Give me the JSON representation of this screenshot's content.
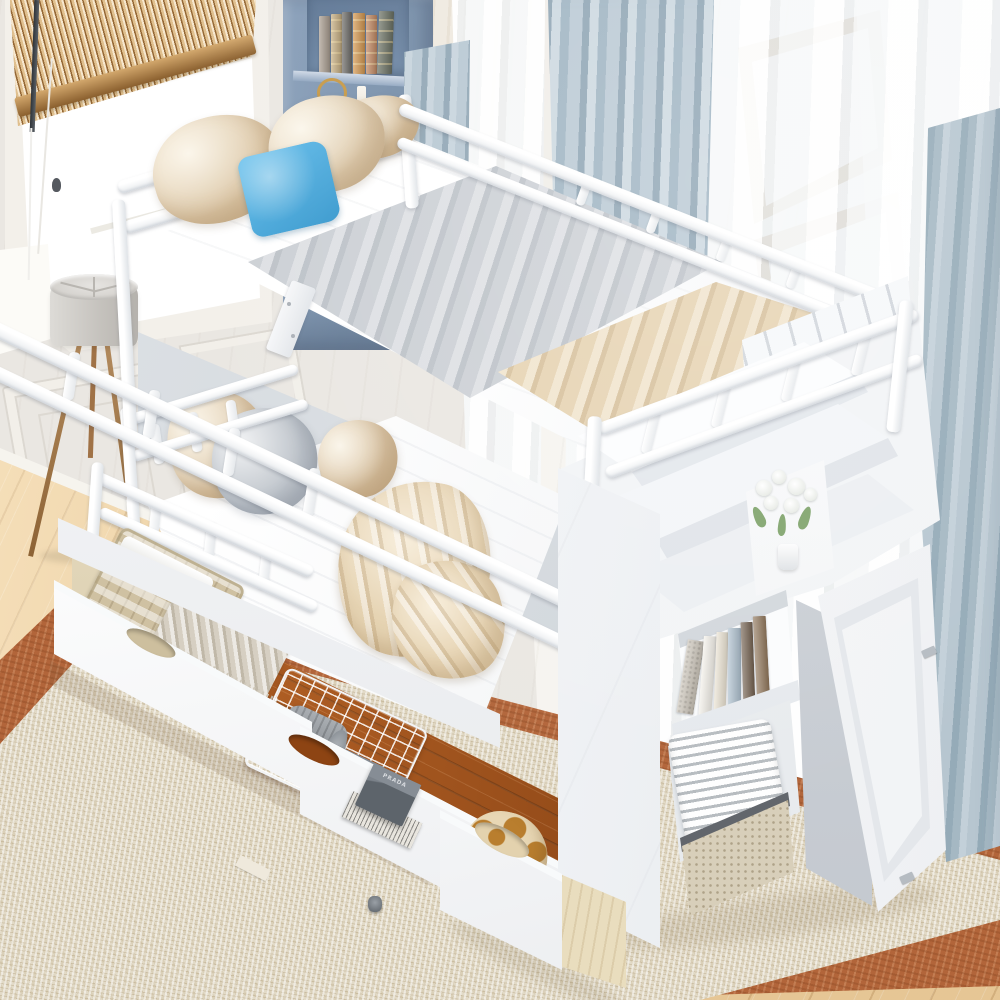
{
  "scene": {
    "description": "Product photo: white twin-over-twin bunk bed with storage staircase, shelves, open cabinet door and two pulled-out trundle storage drawers, in a bright bedroom with bamboo blinds, a blue corner bookshelf, sheer curtains, a tripod floor lamp, wood floor and a beige rug with rust border"
  },
  "labels": {
    "gift_box": "PRADA"
  },
  "palette": {
    "wall": "#eae7e2",
    "wall_sunlit": "#f4f2ed",
    "window_glow": "#ffffff",
    "blind_wood": "#c99e66",
    "blind_wood_dark": "#8a5f2e",
    "corner_shelf_blue": "#768ea9",
    "corner_shelf_shadow": "#5e7694",
    "curtain_blue": "#9fb4c2",
    "curtain_blue_light": "#ccd8e0",
    "curtain_gray": "#a5b8c3",
    "frame_tan": "#bca583",
    "bed_white": "#ffffff",
    "blanket_gray": "#ccd0d5",
    "blanket_beige": "#e6d3b2",
    "floor_wood": "#eccfa2",
    "rug_border": "#b2653a",
    "rug_weave": "#e2dac7",
    "drawer_interior_tan": "#d6c8a6",
    "drawer_interior_orange": "#b05a1e",
    "knit_throw": "#d6cfc2",
    "blanket_roll_gray": "#8d9399",
    "folded_blanket_gray": "#79818a",
    "box_gray": "#5d646b",
    "giraffe_base": "#e8d7b4",
    "giraffe_spot": "#b97e2e",
    "plywood": "#e9ddbe",
    "lamp_shade": "#c4c1bc",
    "lamp_leg": "#8d6335",
    "candle_brass": "#c79a4e",
    "flower_leaf": "#7fa36b"
  },
  "books": {
    "corner_shelf": [
      "#a5988a",
      "#c2a878",
      "#63615d",
      "#d29042",
      "#bd7f55",
      "#5d6455"
    ],
    "stair_shelf": [
      "#c9c2b6",
      "#f3f0e9",
      "#e9e1d0",
      "#a9bccb",
      "#6b5846",
      "#8a6f52"
    ]
  },
  "pillows": {
    "top_bunk": [
      "#e7d2b0",
      "#e9d6b6",
      "#e2cba6",
      "#41b0e8"
    ],
    "lower_bunk": [
      "#e6d2b2",
      "#bcc2c9",
      "#e0c9a6"
    ]
  }
}
